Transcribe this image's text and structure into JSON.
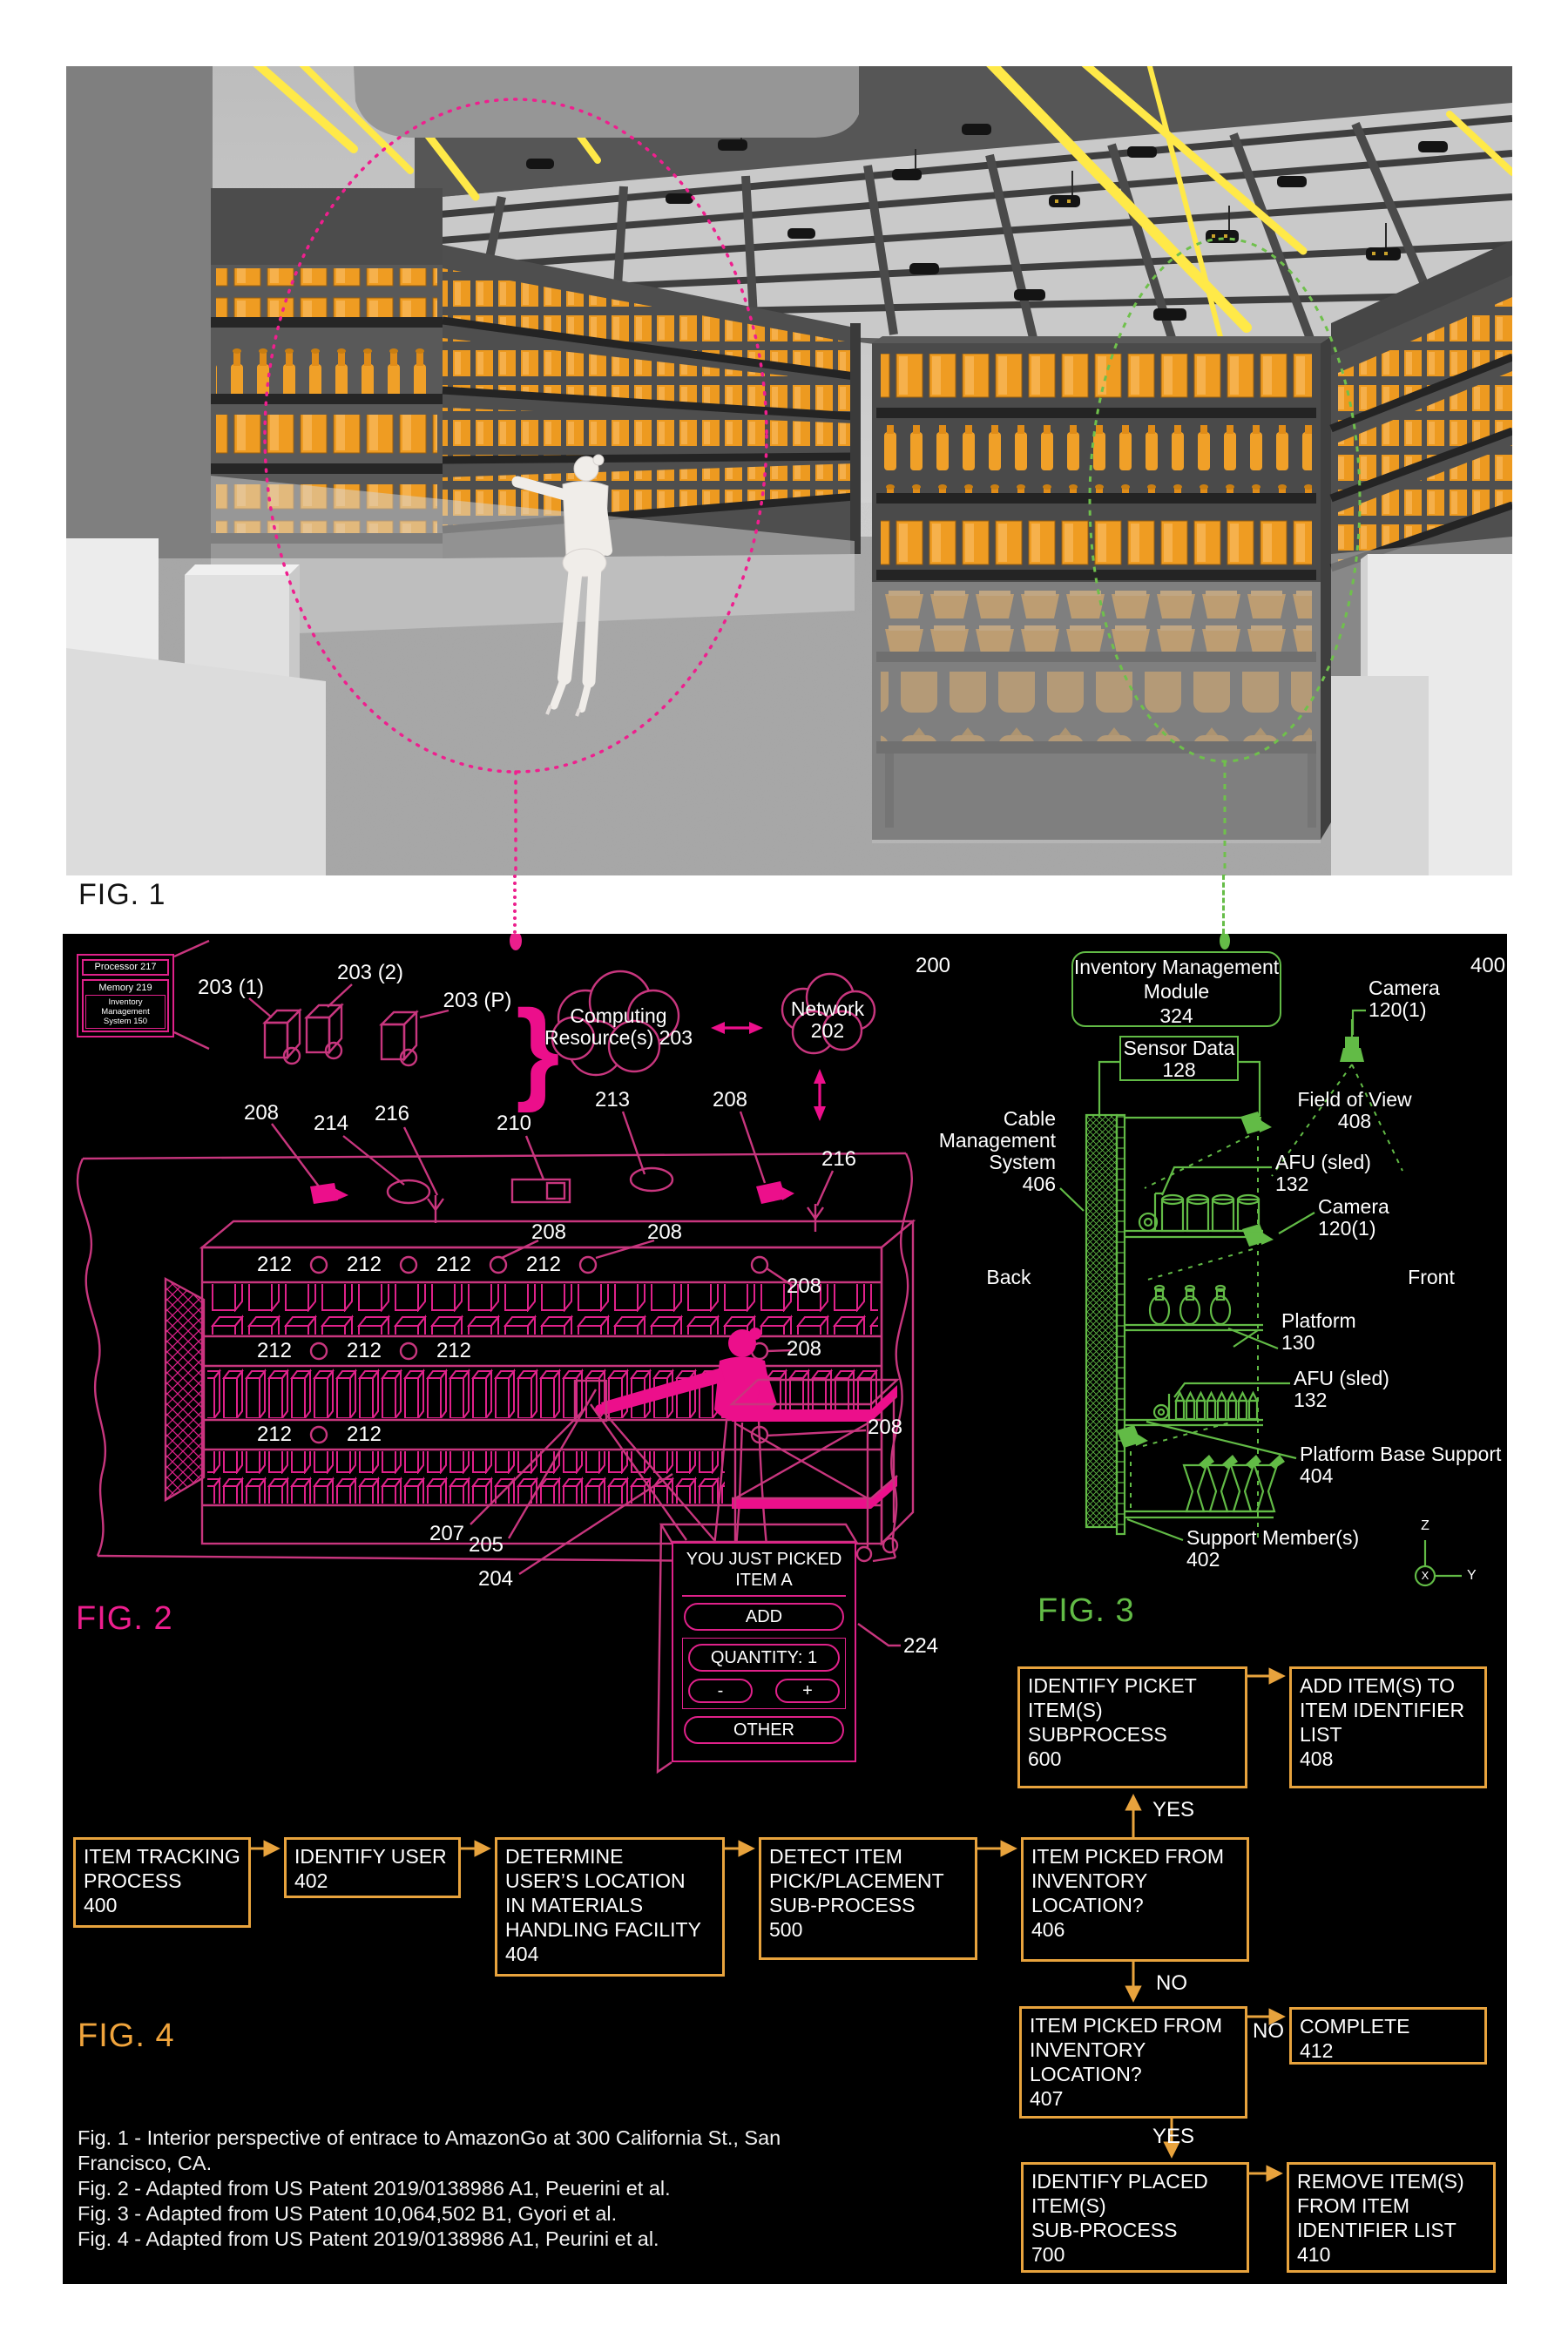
{
  "colors": {
    "magenta": "#EC1E8C",
    "green": "#62BB46",
    "orange": "#E8A33D",
    "yellow": "#FFE94A"
  },
  "fig1": {
    "label": "FIG. 1"
  },
  "fig2": {
    "label": "FIG. 2",
    "processor": "Processor 217",
    "memory": "Memory 219",
    "ims": "Inventory\nManagement\nSystem 150",
    "refs": {
      "r200": "200",
      "r203_1": "203 (1)",
      "r203_2": "203 (2)",
      "r203_p": "203 (P)",
      "r204": "204",
      "r205": "205",
      "r207": "207",
      "r208": "208",
      "r210": "210",
      "r212": "212",
      "r213": "213",
      "r214": "214",
      "r216": "216",
      "r224": "224"
    },
    "clouds": {
      "computing": "Computing\nResource(s) 203",
      "network": "Network\n202"
    },
    "popup": {
      "title": "YOU JUST PICKED\nITEM A",
      "add": "ADD",
      "quantity": "QUANTITY: 1",
      "minus": "-",
      "plus": "+",
      "other": "OTHER"
    }
  },
  "fig3": {
    "label": "FIG. 3",
    "r400": "400",
    "module": "Inventory Management\nModule\n324",
    "sensor": "Sensor Data\n128",
    "camera": "Camera\n120(1)",
    "fov": "Field of View\n408",
    "cable": "Cable\nManagement\nSystem\n406",
    "afu": "AFU (sled)\n132",
    "back": "Back",
    "front": "Front",
    "platform": "Platform\n130",
    "pbs": "Platform Base Support\n404",
    "support": "Support Member(s)\n402",
    "axis": {
      "x": "X",
      "y": "Y",
      "z": "Z"
    }
  },
  "fig4": {
    "label": "FIG. 4",
    "yes": "YES",
    "no": "NO",
    "boxes": {
      "b400": "ITEM TRACKING\nPROCESS\n400",
      "b402": "IDENTIFY USER\n402",
      "b404": "DETERMINE\nUSER’S LOCATION\nIN MATERIALS\nHANDLING FACILITY\n404",
      "b500": "DETECT ITEM\nPICK/PLACEMENT\nSUB-PROCESS\n500",
      "b406": "ITEM PICKED FROM\nINVENTORY\nLOCATION?\n406",
      "b600": "IDENTIFY PICKET\nITEM(S)\nSUBPROCESS\n600",
      "b408": "ADD ITEM(S) TO\nITEM IDENTIFIER\nLIST\n408",
      "b407": "ITEM PICKED FROM\nINVENTORY\nLOCATION?\n407",
      "b412": "COMPLETE\n412",
      "b700": "IDENTIFY PLACED\nITEM(S)\nSUB-PROCESS\n700",
      "b410": "REMOVE ITEM(S)\nFROM ITEM\nIDENTIFIER LIST\n410"
    }
  },
  "captions": [
    "Fig. 1 - Interior perspective of entrace to AmazonGo at 300 California St., San",
    "Francisco, CA.",
    "Fig. 2 - Adapted from US Patent 2019/0138986 A1, Peuerini et al.",
    "Fig. 3 - Adapted from US Patent 10,064,502 B1, Gyori et al.",
    "Fig. 4 - Adapted from US Patent 2019/0138986 A1, Peurini et al."
  ]
}
